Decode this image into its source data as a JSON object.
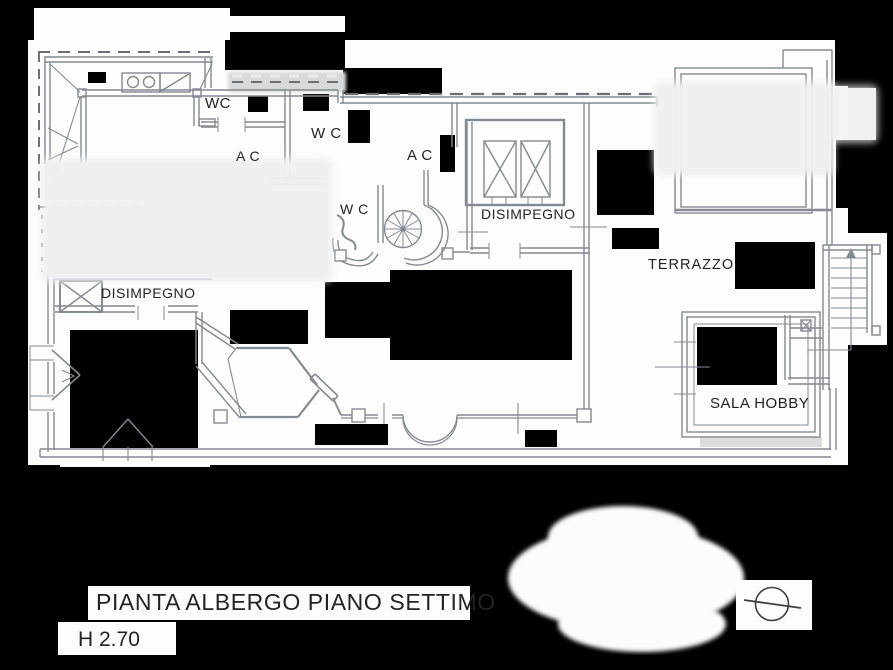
{
  "drawing": {
    "labels": [
      {
        "id": "wc-1",
        "text": "WC"
      },
      {
        "id": "wc-2",
        "text": "W C"
      },
      {
        "id": "ac-1",
        "text": "A C"
      },
      {
        "id": "ac-2",
        "text": "A C"
      },
      {
        "id": "wc-3",
        "text": "W C"
      },
      {
        "id": "disimpegno-top",
        "text": "DISIMPEGNO"
      },
      {
        "id": "disimpegno-left",
        "text": "DISIMPEGNO"
      },
      {
        "id": "terrazzo",
        "text": "TERRAZZO"
      },
      {
        "id": "sala-hobby",
        "text": "SALA HOBBY"
      }
    ],
    "caption": {
      "title": "PIANTA ALBERGO PIANO SETTIMO",
      "height_note": "H 2.70"
    },
    "symbols": [
      {
        "id": "north-indicator",
        "name": "north-symbol"
      }
    ],
    "colors": {
      "background": "#000000",
      "paper": "#fdfdfd",
      "line": "#848a92",
      "text": "#232323",
      "redaction": "#efeff0"
    }
  }
}
